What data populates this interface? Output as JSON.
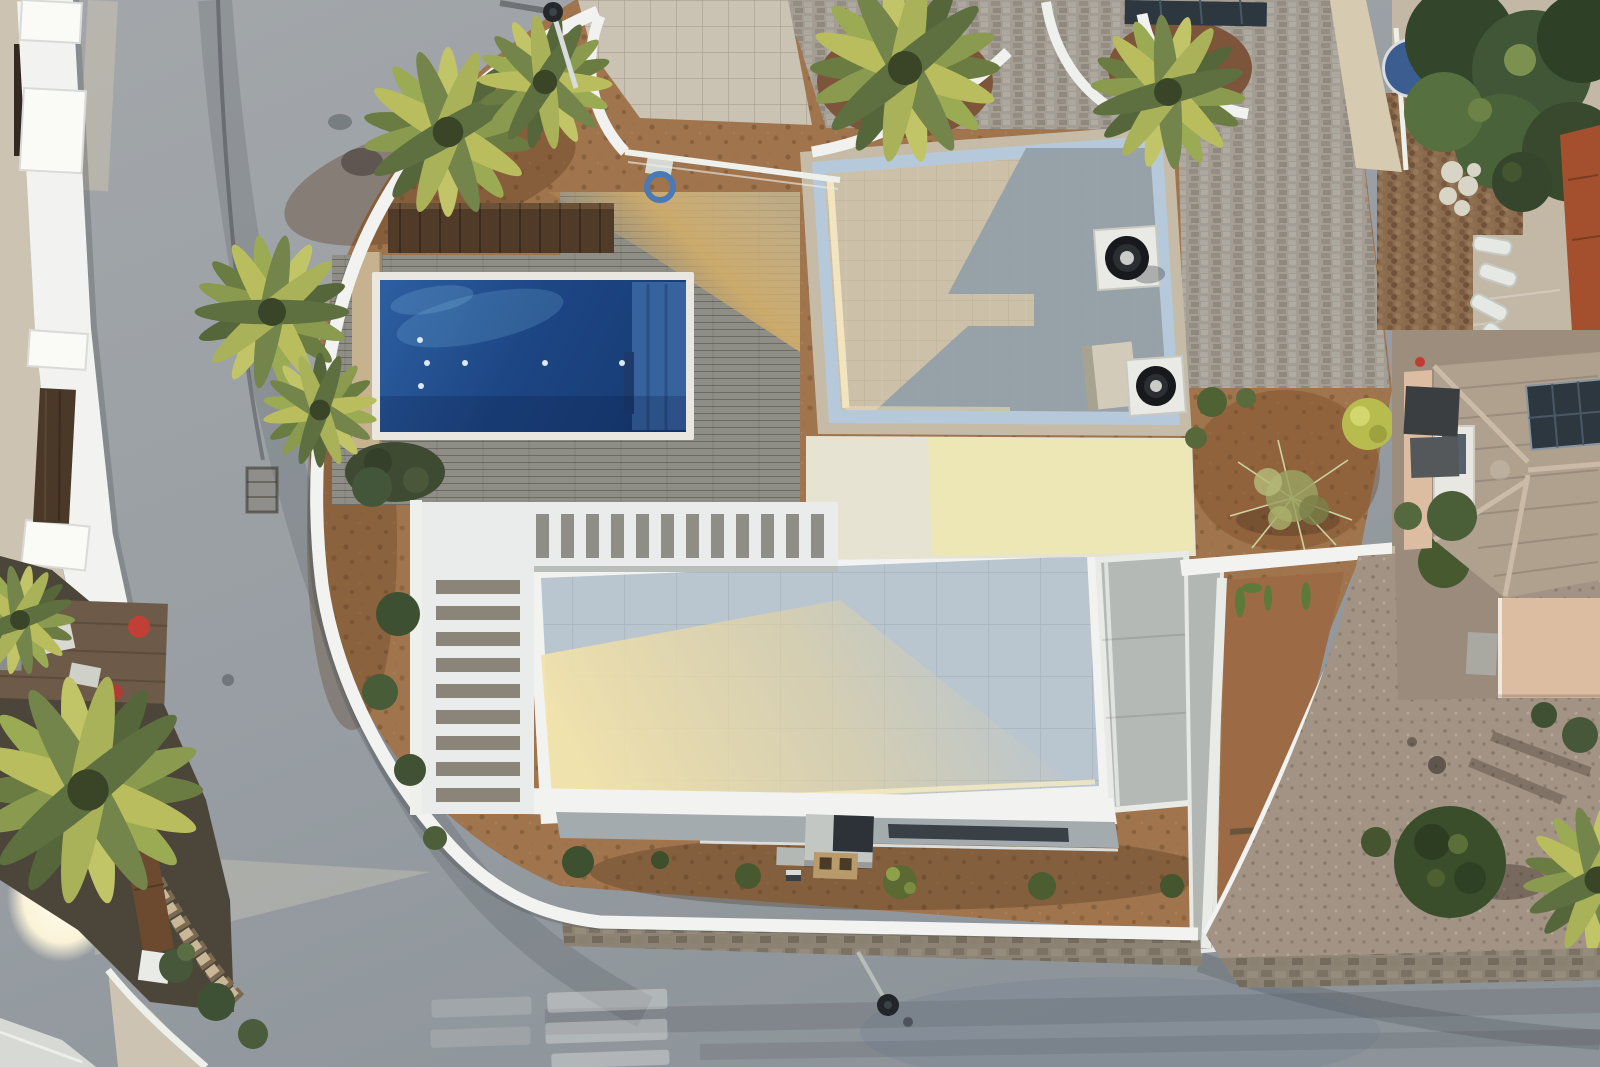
{
  "meta": {
    "type": "aerial drone photograph, top-down (nadir) view",
    "subject": "modern white flat-roof villa with swimming pool, wooden deck and pergola, surrounded by roads and neighbouring houses",
    "lighting": "low warm sun casting long shadows and golden patches",
    "visible_text": "none"
  },
  "palette": {
    "road_gray": "#9aa0a4",
    "pavement_beige": "#cdc3b2",
    "wall_white": "#f2f3f0",
    "deck_gray": "#8f8e86",
    "deck_sun_gold": "#d2ad69",
    "pool_water": "#1f4c8b",
    "pool_deep": "#16366b",
    "pool_steps": "#3a66a2",
    "roof_shade_blue": "#b9c5cf",
    "roof_gold": "#f2e3ac",
    "parapet_beige": "#c6bba7",
    "tile_sun": "#cdc0a9",
    "tile_shadow": "#939ea8",
    "dirt_brown": "#a0744c",
    "dirt_dark": "#7c553a",
    "gravel": "#a29384",
    "vegetation_dark": "#3a4e2c",
    "vegetation_light": "#8a9a4e",
    "palm_yellow": "#c2c468",
    "terracotta_tile": "#b0a08e",
    "brick_red": "#a4502e",
    "peach_stucco": "#dcbda2",
    "cobble_gray": "#a39d94",
    "cobble_brown": "#8a6b4e",
    "hot_tub_blue": "#3c5d90",
    "solar_panel": "#2c3740"
  },
  "scene": {
    "regions": [
      {
        "name": "road-network",
        "description": "gray asphalt road curving along the left side and across the bottom, faded crosswalk stripes bottom centre, manhole, two street lamps"
      },
      {
        "name": "left-neighborhood",
        "description": "beige sidewalk, long white boundary wall with brown gate, sunlit patch, dark garden with large palm, stepped brick wall, clutter on a wooden deck"
      },
      {
        "name": "villa-plot",
        "description": "white curved perimeter wall, gray cobble driveway, blue pool with wood deck, white slatted pergola, cream main roof with golden sunlight, upper roof with two vent fans, dirt gardens with shrubs"
      },
      {
        "name": "right-neighborhood",
        "description": "trees, blue covered hot-tub, brown cobble patio, sun loungers, terracotta hip roof with solar panel, peach flat roof, gravel yard with round bushes"
      }
    ],
    "objects": [
      {
        "name": "swimming-pool",
        "description": "rectangular deep blue pool with step section at its right end and small white lights"
      },
      {
        "name": "pergola",
        "description": "L-shaped white slatted pergola casting over the deck"
      },
      {
        "name": "roof-vent",
        "count": 2,
        "description": "black circular fans on white square bases on the upper roof"
      },
      {
        "name": "street-lamp",
        "count": 2
      },
      {
        "name": "solar-panels",
        "count": 2
      }
    ]
  }
}
